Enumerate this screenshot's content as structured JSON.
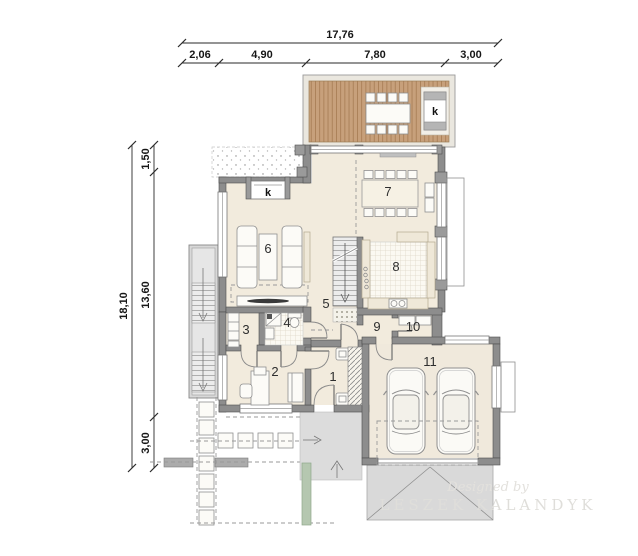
{
  "plan": {
    "dim_top": {
      "total": "17,76",
      "seg": [
        "2,06",
        "4,90",
        "7,80",
        "3,00"
      ]
    },
    "dim_left": {
      "total": "18,10",
      "seg": [
        "1,50",
        "13,60",
        "3,00"
      ]
    },
    "rooms": [
      "1",
      "2",
      "3",
      "4",
      "5",
      "6",
      "7",
      "8",
      "9",
      "10",
      "11"
    ],
    "marks": {
      "terrace_k": "k",
      "living_k": "k"
    },
    "watermark": {
      "line1": "Designed by",
      "line2": "LESZEK KALANDYK"
    },
    "colors": {
      "floor": "#f2ebdd",
      "wall": "#8d8d8d",
      "wood": "#c7a07b",
      "paving": "#dcdcdc",
      "green": "#b5c7b0",
      "tile": "#fbf9f2"
    }
  }
}
